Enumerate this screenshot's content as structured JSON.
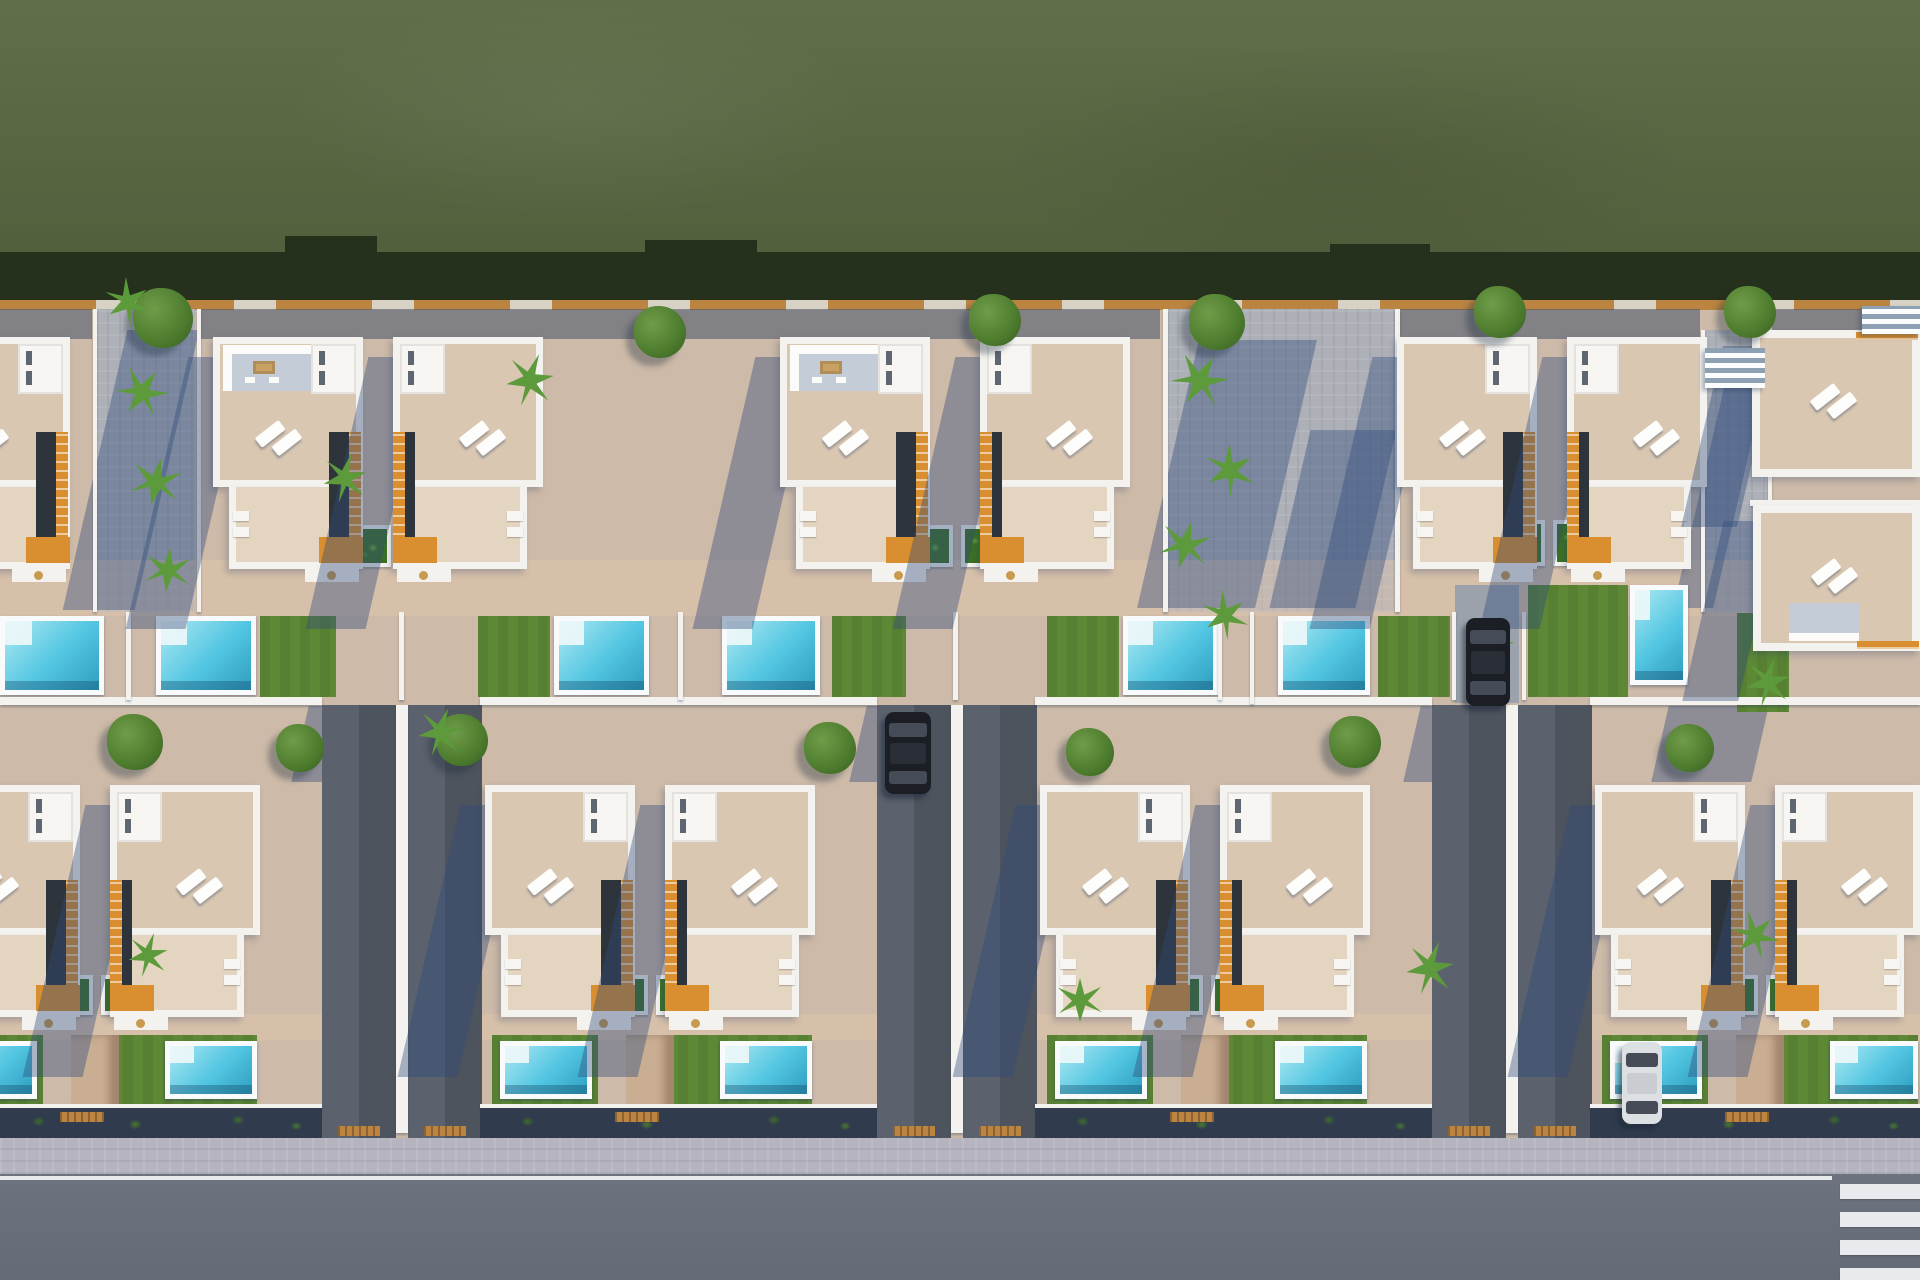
{
  "meta": {
    "kind": "aerial-3d-render",
    "subject": "residential-villa-development-top-view",
    "canvas": {
      "w": 1920,
      "h": 1280
    }
  },
  "palette": {
    "grass": "#5a6942",
    "grassShadow": "#25311c",
    "ground": "#cdbaa8",
    "timber": "#bb8440",
    "walkway": "#aeb0b8",
    "wallWhite": "#f3f2ef",
    "terrace": "#d9c7b2",
    "terraceLow": "#e4d5c1",
    "kitchenFloor": "#c4cdd7",
    "stairOrange": "#d98f2f",
    "stairDark": "#2e343b",
    "lawn": "#5d8836",
    "pool": "#52c6e2",
    "poolLight": "#aee8f1",
    "poolDark": "#2f9ec0",
    "coping": "#f8fafb",
    "planterGreen": "#3c7026",
    "treeGreen": "#4d7c2e",
    "palmGreen": "#5d9a3c",
    "driveway": "#5b626d",
    "road": "#737a86",
    "sidewalk": "#b5b4bf",
    "lineWhite": "#e9eaee",
    "hedge": "#303b4d",
    "carBlack": "#1b1e24",
    "carWhite": "#dde0e3",
    "shadow": "rgba(47,76,122,0.40)"
  },
  "zones": {
    "grass": [
      0,
      0,
      1920,
      276
    ],
    "grass_shadow": [
      0,
      252,
      1920,
      56
    ],
    "shadow_bumps": [
      [
        285,
        236,
        92,
        20
      ],
      [
        645,
        240,
        112,
        16
      ],
      [
        1330,
        244,
        100,
        14
      ]
    ],
    "back_wall": [
      0,
      300,
      1920,
      10
    ],
    "rear_shade_row1": [
      [
        0,
        309,
        92,
        30
      ],
      [
        198,
        309,
        962,
        30
      ],
      [
        1400,
        309,
        300,
        30
      ],
      [
        1772,
        309,
        148,
        30
      ]
    ],
    "patio_lit": [
      [
        0,
        560,
        1920,
        56
      ],
      [
        0,
        1014,
        1920,
        26
      ]
    ],
    "sidewalk": [
      0,
      1138,
      1920,
      36
    ],
    "road": [
      0,
      1174,
      1920,
      106
    ],
    "road_line": [
      0,
      1176,
      1832,
      4
    ],
    "crosswalk": [
      [
        1840,
        1184,
        80,
        15
      ],
      [
        1840,
        1212,
        80,
        15
      ],
      [
        1840,
        1240,
        80,
        15
      ],
      [
        1840,
        1268,
        80,
        12
      ]
    ],
    "ext_stair_top_right": [
      1862,
      306,
      58,
      28
    ]
  },
  "walkways": [
    [
      95,
      309,
      100,
      303
    ],
    [
      1165,
      309,
      232,
      303
    ],
    [
      1703,
      330,
      67,
      282
    ]
  ],
  "ambient_shadows": [
    [
      95,
      330,
      72,
      280
    ],
    [
      1168,
      340,
      118,
      268
    ],
    [
      1290,
      430,
      86,
      178
    ],
    [
      1703,
      350,
      40,
      258
    ],
    [
      300,
      706,
      110,
      76
    ],
    [
      858,
      706,
      110,
      76
    ],
    [
      1412,
      706,
      110,
      76
    ],
    [
      1660,
      706,
      100,
      76
    ]
  ],
  "thin_walls": [
    [
      93,
      309,
      4,
      303
    ],
    [
      197,
      309,
      4,
      303
    ],
    [
      1163,
      309,
      5,
      303
    ],
    [
      1395,
      309,
      5,
      303
    ],
    [
      1701,
      330,
      4,
      282
    ],
    [
      1768,
      330,
      4,
      282
    ],
    [
      1750,
      500,
      170,
      6
    ],
    [
      126,
      612,
      5,
      88
    ],
    [
      399,
      612,
      5,
      88
    ],
    [
      678,
      612,
      5,
      88
    ],
    [
      953,
      612,
      5,
      88
    ],
    [
      1218,
      612,
      4,
      88
    ],
    [
      1250,
      612,
      4,
      92
    ],
    [
      1452,
      612,
      4,
      88
    ],
    [
      1522,
      612,
      4,
      88
    ]
  ],
  "mid_wall_segments": [
    [
      0,
      697,
      322,
      8
    ],
    [
      480,
      697,
      397,
      8
    ],
    [
      1035,
      697,
      397,
      8
    ],
    [
      1590,
      697,
      330,
      8
    ]
  ],
  "driveway_pairs": {
    "y": 705,
    "h": 433,
    "lanes": [
      [
        322,
        74
      ],
      [
        408,
        74
      ],
      [
        877,
        74
      ],
      [
        963,
        74
      ],
      [
        1432,
        74
      ],
      [
        1518,
        74
      ]
    ],
    "walls": [
      [
        396,
        705,
        12,
        428
      ],
      [
        951,
        705,
        12,
        428
      ],
      [
        1506,
        705,
        12,
        428
      ]
    ],
    "mats": [
      [
        338,
        1126,
        42,
        10
      ],
      [
        424,
        1126,
        42,
        10
      ],
      [
        893,
        1126,
        42,
        10
      ],
      [
        979,
        1126,
        42,
        10
      ],
      [
        1448,
        1126,
        42,
        10
      ],
      [
        1534,
        1126,
        42,
        10
      ]
    ]
  },
  "top_lane": [
    1455,
    585,
    64,
    118
  ],
  "pools_row1": [
    [
      0,
      616,
      104,
      79
    ],
    [
      156,
      616,
      100,
      79
    ],
    [
      554,
      616,
      95,
      79
    ],
    [
      722,
      616,
      98,
      79
    ],
    [
      1123,
      616,
      95,
      79
    ],
    [
      1278,
      616,
      92,
      79
    ],
    [
      1630,
      585,
      58,
      100
    ]
  ],
  "lawns_row1": [
    [
      260,
      616,
      76,
      81
    ],
    [
      478,
      616,
      72,
      81
    ],
    [
      832,
      616,
      74,
      81
    ],
    [
      1047,
      616,
      72,
      81
    ],
    [
      1378,
      616,
      72,
      81
    ],
    [
      1528,
      585,
      100,
      112
    ],
    [
      1737,
      613,
      52,
      99
    ]
  ],
  "pools_row2": [
    [
      -55,
      1041,
      92,
      58
    ],
    [
      165,
      1041,
      92,
      58
    ],
    [
      500,
      1041,
      92,
      58
    ],
    [
      720,
      1041,
      92,
      58
    ],
    [
      1055,
      1041,
      92,
      58
    ],
    [
      1275,
      1041,
      92,
      58
    ],
    [
      1610,
      1041,
      92,
      58
    ],
    [
      1830,
      1041,
      88,
      58
    ]
  ],
  "lawns_row2": [
    [
      -63,
      1035,
      106,
      80
    ],
    [
      103,
      1035,
      154,
      80
    ],
    [
      492,
      1035,
      106,
      80
    ],
    [
      658,
      1035,
      154,
      80
    ],
    [
      1047,
      1035,
      106,
      80
    ],
    [
      1213,
      1035,
      154,
      80
    ],
    [
      1602,
      1035,
      106,
      80
    ],
    [
      1768,
      1035,
      150,
      80
    ]
  ],
  "yard_pillars": [
    [
      71,
      1035,
      48,
      80
    ],
    [
      626,
      1035,
      48,
      80
    ],
    [
      1181,
      1035,
      48,
      80
    ],
    [
      1736,
      1035,
      48,
      80
    ]
  ],
  "loungers": [
    [
      272,
      640,
      -38
    ],
    [
      488,
      640,
      -38
    ],
    [
      840,
      640,
      -38
    ],
    [
      1052,
      640,
      -38
    ],
    [
      1388,
      640,
      -38
    ],
    [
      1566,
      650,
      -38
    ],
    [
      118,
      1058,
      -38
    ],
    [
      673,
      1058,
      -38
    ],
    [
      1228,
      1058,
      -38
    ],
    [
      1783,
      1058,
      -38
    ]
  ],
  "planters": [
    [
      343,
      525,
      48,
      42
    ],
    [
      399,
      525,
      48,
      42
    ],
    [
      905,
      525,
      48,
      42
    ],
    [
      961,
      525,
      48,
      42
    ],
    [
      1497,
      520,
      48,
      46
    ],
    [
      1553,
      520,
      48,
      46
    ],
    [
      45,
      975,
      48,
      40
    ],
    [
      101,
      975,
      48,
      40
    ],
    [
      600,
      975,
      48,
      40
    ],
    [
      656,
      975,
      48,
      40
    ],
    [
      1155,
      975,
      48,
      40
    ],
    [
      1211,
      975,
      48,
      40
    ],
    [
      1710,
      975,
      48,
      40
    ],
    [
      1766,
      975,
      48,
      40
    ]
  ],
  "trees": [
    [
      163,
      318,
      30
    ],
    [
      660,
      332,
      26
    ],
    [
      995,
      320,
      26
    ],
    [
      1217,
      322,
      28
    ],
    [
      1500,
      312,
      26
    ],
    [
      1750,
      312,
      26
    ],
    [
      135,
      742,
      28
    ],
    [
      300,
      748,
      24
    ],
    [
      462,
      740,
      26
    ],
    [
      830,
      748,
      26
    ],
    [
      1090,
      752,
      24
    ],
    [
      1355,
      742,
      26
    ],
    [
      1690,
      748,
      24
    ]
  ],
  "palms": [
    [
      128,
      302,
      22
    ],
    [
      142,
      392,
      24
    ],
    [
      156,
      482,
      24
    ],
    [
      168,
      570,
      22
    ],
    [
      345,
      478,
      22
    ],
    [
      530,
      380,
      24
    ],
    [
      1200,
      380,
      26
    ],
    [
      1230,
      470,
      24
    ],
    [
      1185,
      545,
      24
    ],
    [
      1225,
      615,
      22
    ],
    [
      1492,
      642,
      20
    ],
    [
      1768,
      682,
      22
    ],
    [
      440,
      732,
      22
    ],
    [
      148,
      955,
      20
    ],
    [
      1080,
      1000,
      22
    ],
    [
      1430,
      968,
      24
    ],
    [
      1755,
      935,
      22
    ]
  ],
  "house_proto": {
    "w": 150,
    "mainH": 150,
    "wingH": 82,
    "porchH": 13
  },
  "houses": [
    {
      "x": -80,
      "y": 337,
      "stair": "r",
      "kitchen": false,
      "row": 1
    },
    {
      "x": 213,
      "y": 337,
      "stair": "r",
      "kitchen": true,
      "row": 1
    },
    {
      "x": 393,
      "y": 337,
      "stair": "l",
      "kitchen": false,
      "row": 1
    },
    {
      "x": 780,
      "y": 337,
      "stair": "r",
      "kitchen": true,
      "row": 1
    },
    {
      "x": 980,
      "y": 337,
      "stair": "l",
      "kitchen": false,
      "row": 1
    },
    {
      "x": 1397,
      "y": 337,
      "stair": "r",
      "kitchen": false,
      "w": 140,
      "row": 1
    },
    {
      "x": 1567,
      "y": 337,
      "stair": "l",
      "kitchen": false,
      "w": 140,
      "row": 1
    },
    {
      "x": -70,
      "y": 785,
      "stair": "r",
      "kitchen": false,
      "row": 2
    },
    {
      "x": 110,
      "y": 785,
      "stair": "l",
      "kitchen": false,
      "row": 2
    },
    {
      "x": 485,
      "y": 785,
      "stair": "r",
      "kitchen": false,
      "row": 2
    },
    {
      "x": 665,
      "y": 785,
      "stair": "l",
      "kitchen": false,
      "row": 2
    },
    {
      "x": 1040,
      "y": 785,
      "stair": "r",
      "kitchen": false,
      "row": 2
    },
    {
      "x": 1220,
      "y": 785,
      "stair": "l",
      "kitchen": false,
      "row": 2
    },
    {
      "x": 1595,
      "y": 785,
      "stair": "r",
      "kitchen": false,
      "row": 2
    },
    {
      "x": 1775,
      "y": 785,
      "stair": "l",
      "kitchen": false,
      "w": 145,
      "row": 2
    }
  ],
  "flat_houses": [
    {
      "x": 1752,
      "y": 330,
      "w": 168,
      "h": 147,
      "kitchen": "none",
      "band": "top"
    },
    {
      "x": 1753,
      "y": 505,
      "w": 167,
      "h": 146,
      "kitchen": "bottom",
      "band": "bottom"
    }
  ],
  "louver_bridge": [
    1705,
    348,
    60,
    40
  ],
  "cars": [
    {
      "x": 885,
      "y": 712,
      "w": 46,
      "h": 82,
      "color": "black"
    },
    {
      "x": 1466,
      "y": 618,
      "w": 44,
      "h": 88,
      "color": "black"
    },
    {
      "x": 1622,
      "y": 1042,
      "w": 40,
      "h": 82,
      "color": "white"
    }
  ],
  "hedge_segments": [
    [
      0,
      1108,
      322,
      30
    ],
    [
      480,
      1108,
      397,
      30
    ],
    [
      1035,
      1108,
      397,
      30
    ],
    [
      1590,
      1108,
      330,
      30
    ]
  ],
  "front_wall_segments": [
    [
      0,
      1104,
      322,
      6
    ],
    [
      480,
      1104,
      397,
      6
    ],
    [
      1035,
      1104,
      397,
      6
    ],
    [
      1590,
      1104,
      330,
      6
    ]
  ],
  "hedge_mats": [
    [
      60,
      1112,
      44,
      10
    ],
    [
      615,
      1112,
      44,
      10
    ],
    [
      1170,
      1112,
      44,
      10
    ],
    [
      1725,
      1112,
      44,
      10
    ]
  ]
}
